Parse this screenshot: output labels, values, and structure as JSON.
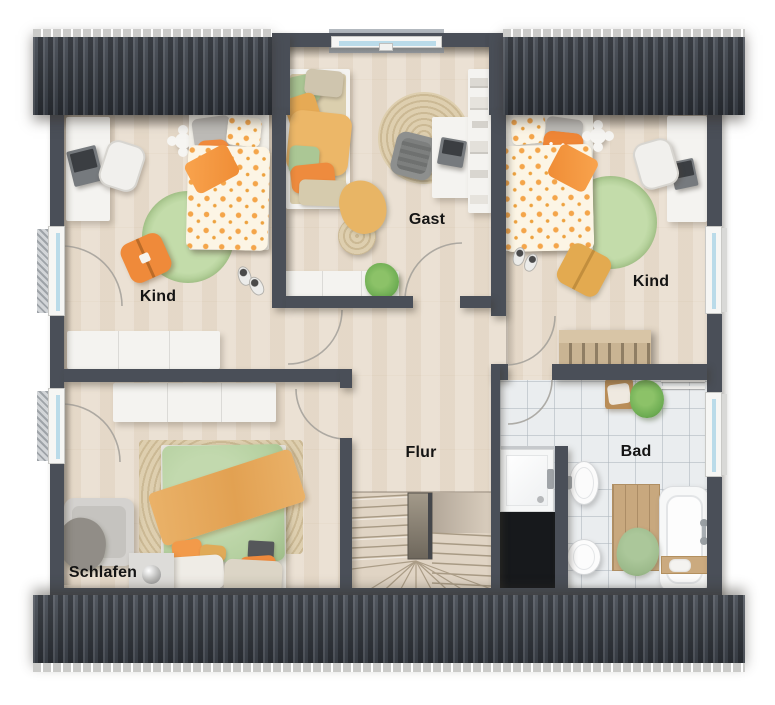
{
  "plan": {
    "type": "floor-plan-upper-storey",
    "rooms": {
      "kind_left": {
        "label": "Kind"
      },
      "gast": {
        "label": "Gast"
      },
      "kind_right": {
        "label": "Kind"
      },
      "schlafen": {
        "label": "Schlafen"
      },
      "flur": {
        "label": "Flur"
      },
      "bad": {
        "label": "Bad"
      }
    },
    "colors": {
      "roof": "#3e444d",
      "wall": "#4a4f58",
      "floor_wood": "#e9decf",
      "floor_tile": "#eaedef",
      "accent_orange": "#f0913f",
      "accent_mustard": "#e8b366",
      "accent_green_rug": "#b7d49c",
      "accent_sage_bedding": "#b5d0a0",
      "window_glass": "#badbe9",
      "shaft_void": "#17191c",
      "stair_wood": "#e0d4c4"
    }
  }
}
